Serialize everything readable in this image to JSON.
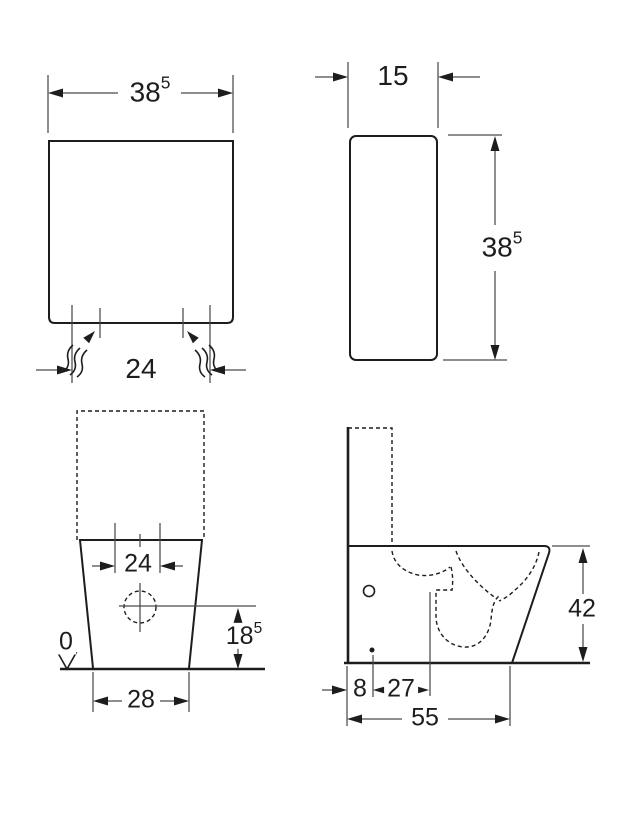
{
  "colors": {
    "background": "#ffffff",
    "object_line": "#1d1d1b",
    "dimension_line": "#4a4a4a",
    "text": "#1d1d1b"
  },
  "views": {
    "cistern_front": {
      "label": "cistern front view",
      "width": {
        "main": "38",
        "sup": "5"
      },
      "supply_spacing": {
        "main": "24"
      }
    },
    "cistern_side": {
      "label": "cistern side view",
      "depth": {
        "main": "15"
      },
      "height": {
        "main": "38",
        "sup": "5"
      }
    },
    "wc_front": {
      "label": "wc pan front view",
      "fixing_spacing": {
        "main": "24"
      },
      "outlet_height": {
        "main": "18",
        "sup": "5"
      },
      "floor_datum": {
        "main": "0"
      },
      "base_width": {
        "main": "28"
      }
    },
    "wc_side": {
      "label": "wc pan side view",
      "rim_height": {
        "main": "42"
      },
      "rear_offset": {
        "main": "8"
      },
      "outlet_offset": {
        "main": "27"
      },
      "total_depth": {
        "main": "55"
      }
    }
  }
}
